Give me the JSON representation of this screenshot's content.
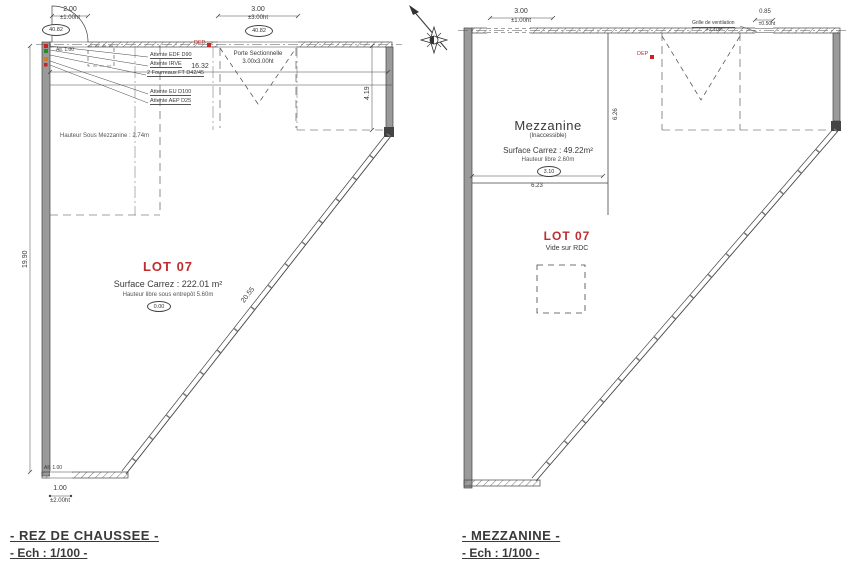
{
  "colors": {
    "accent_red": "#bf2e2e",
    "line": "#3c3c3c",
    "wall_gray": "#9a9a9a"
  },
  "rdc": {
    "title": "- REZ DE CHAUSSEE -",
    "scale_label": "- Ech : 1/100 -",
    "lot_label": "LOT 07",
    "lot_surface": "Surface Carrez : 222.01 m²",
    "lot_height_note": "Hauteur libre sous entrepôt 5.60m",
    "lot_level": "0.00",
    "mezz_height_note": "Hauteur Sous Mezzanine : 2.74m",
    "door": {
      "dim": "2.00",
      "ht": "±1.00ht",
      "level": "40.82"
    },
    "sectional": {
      "line1": "Porte Sectionnelle",
      "line2": "3.00x3.00ht",
      "dim": "3.00",
      "ht": "±3.00ht",
      "level": "40.82"
    },
    "dep": "DEP",
    "attentes": [
      "Attente EDF D90",
      "Attente IRVE",
      "2 Fourreaux FT D42/45",
      "Attente EU D100",
      "Attente AEP D25"
    ],
    "dim_width": "16.32",
    "dim_left": "19.90",
    "dim_right": "4.19",
    "dim_diag": "20.55",
    "door_bottom_dim": "1.00",
    "door_bottom_ht": "±2.00ht",
    "sill_top": "All. 1.00",
    "sill_bottom": "All. 1.00"
  },
  "mezz": {
    "title": "- MEZZANINE -",
    "scale_label": "- Ech : 1/100 -",
    "room_name": "Mezzanine",
    "room_sub": "(Inaccessible)",
    "room_surface": "Surface Carrez : 49.22m²",
    "room_height_note": "Hauteur libre 2.60m",
    "room_level": "3.10",
    "dim_w": "6.23",
    "dim_h": "6.26",
    "lot_label": "LOT 07",
    "lot_sub": "Vide sur RDC",
    "vent_label": "Grille de ventilation",
    "vent_sub": "+2.70ht",
    "vent_dim": "0.85",
    "vent_ht": "±0.50ht",
    "top_dim": "3.00",
    "top_ht": "±1.00ht",
    "dep": "DEP"
  }
}
